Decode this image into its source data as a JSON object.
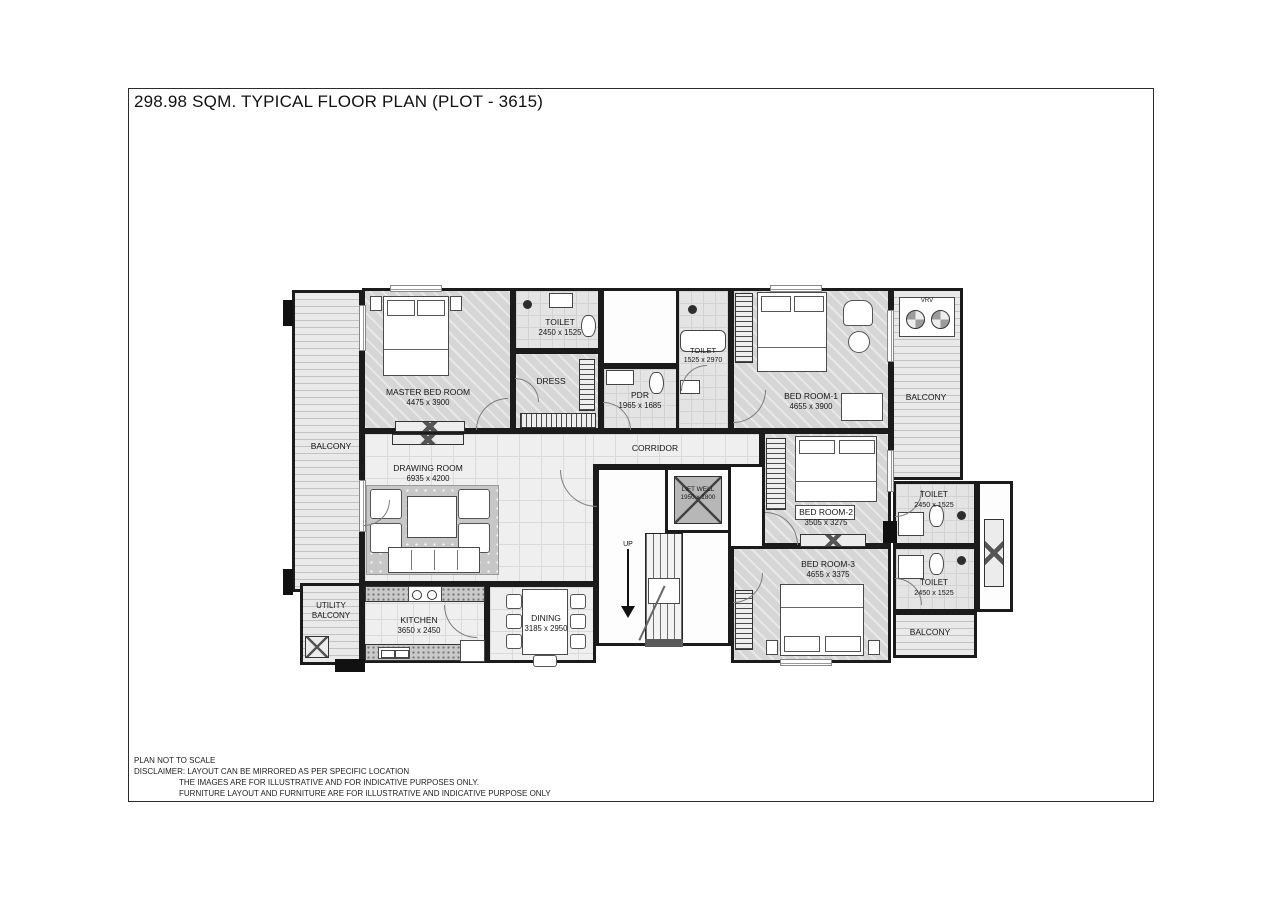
{
  "page": {
    "title": "298.98 SQM. TYPICAL FLOOR PLAN (PLOT - 3615)"
  },
  "footer": {
    "line1": "PLAN NOT TO SCALE",
    "line2": "DISCLAIMER: LAYOUT CAN BE MIRRORED AS PER SPECIFIC LOCATION",
    "line3": "THE IMAGES ARE FOR ILLUSTRATIVE AND FOR INDICATIVE PURPOSES ONLY.",
    "line4": "FURNITURE LAYOUT AND FURNITURE ARE FOR ILLUSTRATIVE AND INDICATIVE PURPOSE ONLY"
  },
  "rooms": {
    "master_bedroom": {
      "name": "MASTER BED ROOM",
      "dim": "4475 x 3900"
    },
    "toilet_master": {
      "name": "TOILET",
      "dim": "2450 x 1525"
    },
    "dress": {
      "name": "DRESS"
    },
    "pdr": {
      "name": "PDR",
      "dim": "1965 x 1685"
    },
    "toilet_br1": {
      "name": "TOILET",
      "dim": "1525 x 2970"
    },
    "bedroom_1": {
      "name": "BED ROOM-1",
      "dim": "4655 x 3900"
    },
    "balcony_left": {
      "name": "BALCONY"
    },
    "utility_balcony": {
      "name": "UTILITY BALCONY"
    },
    "corridor": {
      "name": "CORRIDOR"
    },
    "drawing_room": {
      "name": "DRAWING ROOM",
      "dim": "6935 x 4200"
    },
    "lift_well": {
      "name": "LIFT WELL",
      "dim": "1950 x 1800"
    },
    "stair": {
      "name": "UP"
    },
    "bedroom_2": {
      "name": "BED ROOM-2",
      "dim": "3505 x 3275"
    },
    "bedroom_3": {
      "name": "BED ROOM-3",
      "dim": "4655 x 3375"
    },
    "toilet_r1": {
      "name": "TOILET",
      "dim": "2450 x 1525"
    },
    "toilet_r2": {
      "name": "TOILET",
      "dim": "2450 x 1525"
    },
    "balcony_right_top": {
      "name": "BALCONY"
    },
    "balcony_right_bottom": {
      "name": "BALCONY"
    },
    "kitchen": {
      "name": "KITCHEN",
      "dim": "3650 x 2450"
    },
    "dining": {
      "name": "DINING",
      "dim": "3185 x 2950"
    },
    "vrv": {
      "name": "VRV"
    }
  },
  "colors": {
    "wall": "#1b1b1b",
    "floor_light": "#efefef",
    "floor_carpet": "#d6d6d6",
    "lift_fill": "#b7b7b7"
  }
}
